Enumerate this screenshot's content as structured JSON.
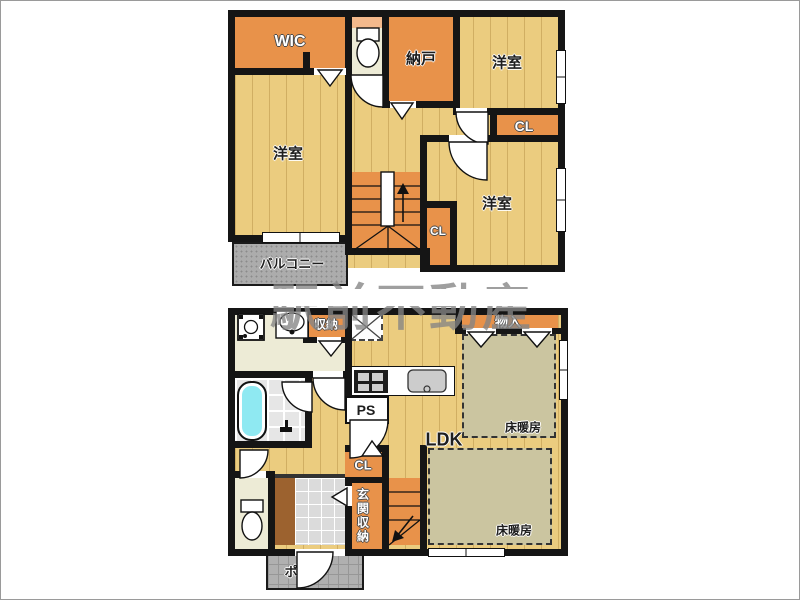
{
  "watermark": {
    "text": "駅前不動産"
  },
  "floor2": {
    "wic": "WIC",
    "nando": "納戸",
    "bedroom_ne": "洋室",
    "closet_e": "CL",
    "bedroom_w": "洋室",
    "bedroom_se": "洋室",
    "closet_s": "CL",
    "balcony": "バルコニー"
  },
  "floor1": {
    "storage": "収納",
    "monoire": "物入",
    "ps": "PS",
    "ldk": "LDK",
    "floor_heating_a": "床暖房",
    "floor_heating_b": "床暖房",
    "closet": "CL",
    "entrance_storage": "玄関収納",
    "porch": "ポーチ"
  },
  "colors": {
    "wall": "#151515",
    "room_orange": "#E8924A",
    "wood_floor": "#EBCC7F",
    "cream_floor": "#EDEBD6",
    "heating_area": "#CBC5A0",
    "bathtub": "#8FE9F2",
    "balcony_gray": "#ACACAC",
    "porch_gray": "#B0B0B0",
    "toilet_counter": "#F4B98C",
    "watermark_gray": "#858585"
  }
}
